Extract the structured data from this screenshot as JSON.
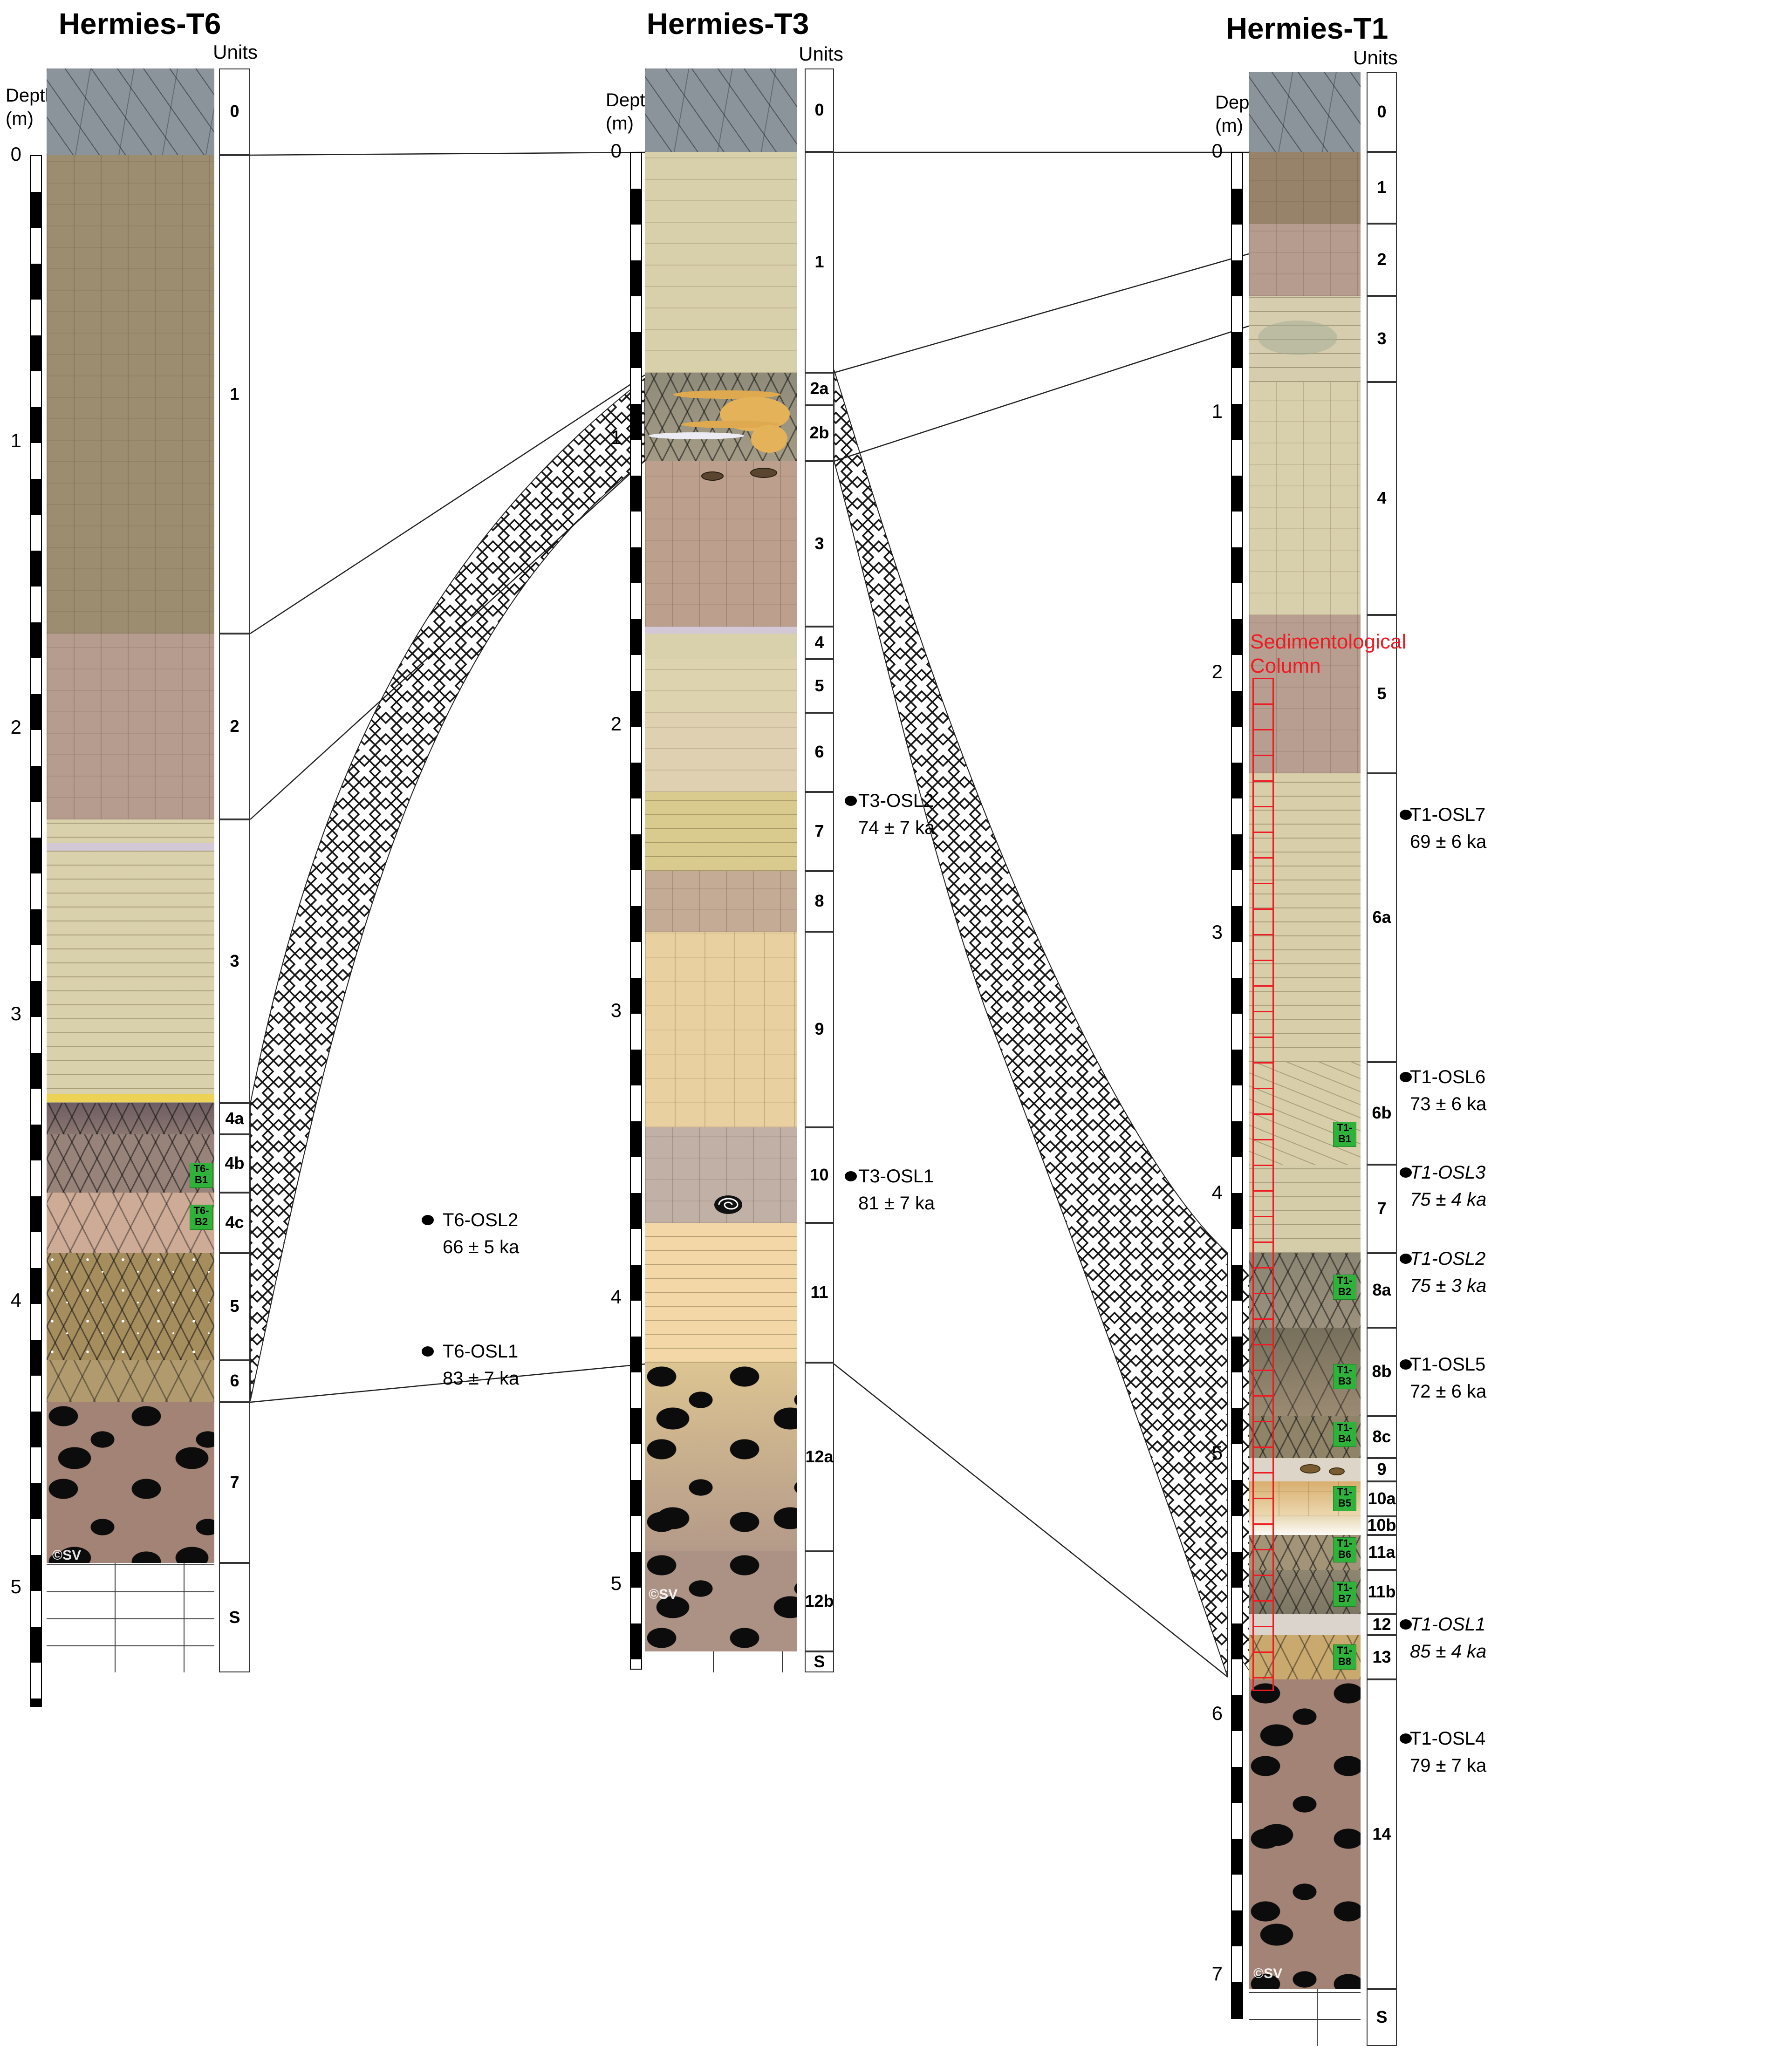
{
  "profiles": [
    {
      "id": "t6",
      "title": "Hermies-T6",
      "units_header": "Units",
      "depth_label_line1": "Depth",
      "depth_label_line2": "(m)",
      "depth_marks": [
        "0",
        "1",
        "2",
        "3",
        "4",
        "5"
      ],
      "units": [
        {
          "label": "0"
        },
        {
          "label": "1"
        },
        {
          "label": "2"
        },
        {
          "label": "3"
        },
        {
          "label": "4a"
        },
        {
          "label": "4b"
        },
        {
          "label": "4c"
        },
        {
          "label": "5"
        },
        {
          "label": "6"
        },
        {
          "label": "7"
        },
        {
          "label": "S"
        }
      ],
      "osl_samples": [
        {
          "name": "T6-OSL2",
          "age": "66 ± 5 ka",
          "italic": false
        },
        {
          "name": "T6-OSL1",
          "age": "83 ± 7 ka",
          "italic": false
        }
      ],
      "block_samples": [
        {
          "line1": "T6-",
          "line2": "B1"
        },
        {
          "line1": "T6-",
          "line2": "B2"
        }
      ],
      "watermark": "©SV"
    },
    {
      "id": "t3",
      "title": "Hermies-T3",
      "units_header": "Units",
      "depth_label_line1": "Depth",
      "depth_label_line2": "(m)",
      "depth_marks": [
        "0",
        "1",
        "2",
        "3",
        "4",
        "5"
      ],
      "units": [
        {
          "label": "0"
        },
        {
          "label": "1"
        },
        {
          "label": "2a"
        },
        {
          "label": "2b"
        },
        {
          "label": "3"
        },
        {
          "label": "4"
        },
        {
          "label": "5"
        },
        {
          "label": "6"
        },
        {
          "label": "7"
        },
        {
          "label": "8"
        },
        {
          "label": "9"
        },
        {
          "label": "10"
        },
        {
          "label": "11"
        },
        {
          "label": "12a"
        },
        {
          "label": "12b"
        },
        {
          "label": "S"
        }
      ],
      "osl_samples": [
        {
          "name": "T3-OSL2",
          "age": "74 ± 7 ka",
          "italic": false
        },
        {
          "name": "T3-OSL1",
          "age": "81 ± 7 ka",
          "italic": false
        }
      ],
      "block_samples": [],
      "watermark": "©SV"
    },
    {
      "id": "t1",
      "title": "Hermies-T1",
      "units_header": "Units",
      "depth_label_line1": "Depth",
      "depth_label_line2": "(m)",
      "depth_marks": [
        "0",
        "1",
        "2",
        "3",
        "4",
        "5",
        "6",
        "7"
      ],
      "units": [
        {
          "label": "0"
        },
        {
          "label": "1"
        },
        {
          "label": "2"
        },
        {
          "label": "3"
        },
        {
          "label": "4"
        },
        {
          "label": "5"
        },
        {
          "label": "6a"
        },
        {
          "label": "6b"
        },
        {
          "label": "7"
        },
        {
          "label": "8a"
        },
        {
          "label": "8b"
        },
        {
          "label": "8c"
        },
        {
          "label": "9"
        },
        {
          "label": "10a"
        },
        {
          "label": "10b"
        },
        {
          "label": "11a"
        },
        {
          "label": "11b"
        },
        {
          "label": "12"
        },
        {
          "label": "13"
        },
        {
          "label": "14"
        },
        {
          "label": "S"
        }
      ],
      "osl_samples": [
        {
          "name": "T1-OSL7",
          "age": "69 ± 6 ka",
          "italic": false
        },
        {
          "name": "T1-OSL6",
          "age": "73 ± 6 ka",
          "italic": false
        },
        {
          "name": "T1-OSL3",
          "age": "75 ± 4 ka",
          "italic": true
        },
        {
          "name": "T1-OSL2",
          "age": "75 ± 3 ka",
          "italic": true
        },
        {
          "name": "T1-OSL5",
          "age": "72 ± 6 ka",
          "italic": false
        },
        {
          "name": "T1-OSL1",
          "age": "85 ± 4 ka",
          "italic": true
        },
        {
          "name": "T1-OSL4",
          "age": "79 ± 7 ka",
          "italic": false
        }
      ],
      "block_samples": [
        {
          "line1": "T1-",
          "line2": "B1"
        },
        {
          "line1": "T1-",
          "line2": "B2"
        },
        {
          "line1": "T1-",
          "line2": "B3"
        },
        {
          "line1": "T1-",
          "line2": "B4"
        },
        {
          "line1": "T1-",
          "line2": "B5"
        },
        {
          "line1": "T1-",
          "line2": "B6"
        },
        {
          "line1": "T1-",
          "line2": "B7"
        },
        {
          "line1": "T1-",
          "line2": "B8"
        }
      ],
      "annotation_line1": "Sedimentological",
      "annotation_line2": "Column",
      "watermark": "©SV"
    }
  ]
}
